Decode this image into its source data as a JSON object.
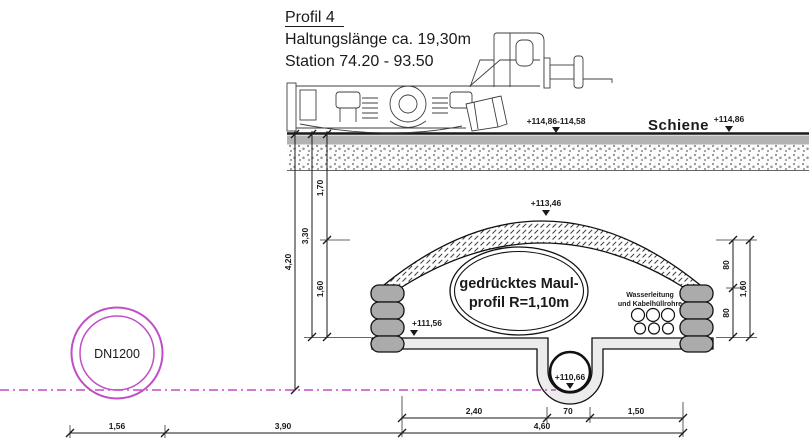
{
  "title": {
    "line1": "Profil 4",
    "line2": "Haltungslänge ca. 19,30m",
    "line3": "Station 74.20 - 93.50"
  },
  "rail": {
    "label": "Schiene"
  },
  "levels": {
    "rail_left": "+114,86-114,58",
    "rail_right": "+114,86",
    "crown": "+113,46",
    "bench": "+111,56",
    "invert": "+110,66"
  },
  "tunnel": {
    "profile_line1": "gedrücktes Maul-",
    "profile_line2": "profil R=1,10m",
    "utilities_line1": "Wasserleitung",
    "utilities_line2": "und Kabelhüllrohre"
  },
  "pipe": {
    "label": "DN1200"
  },
  "dimensions": {
    "left": {
      "seg_170": "1,70",
      "seg_330": "3,30",
      "seg_160": "1,60",
      "seg_420": "4,20"
    },
    "right": {
      "seg_80_top": "80",
      "seg_160": "1,60",
      "seg_80_bottom": "80"
    },
    "bottom": {
      "seg_240": "2,40",
      "seg_70": "70",
      "seg_150": "1,50",
      "seg_460": "4,60",
      "seg_156": "1,56",
      "seg_390": "3,90"
    }
  },
  "colors": {
    "magenta": "#c14ec6",
    "drawing_line": "#1a1a1a",
    "concrete_fill": "#ececec",
    "block_fill": "#ababab",
    "ballast_band": "#b3b3b3"
  }
}
